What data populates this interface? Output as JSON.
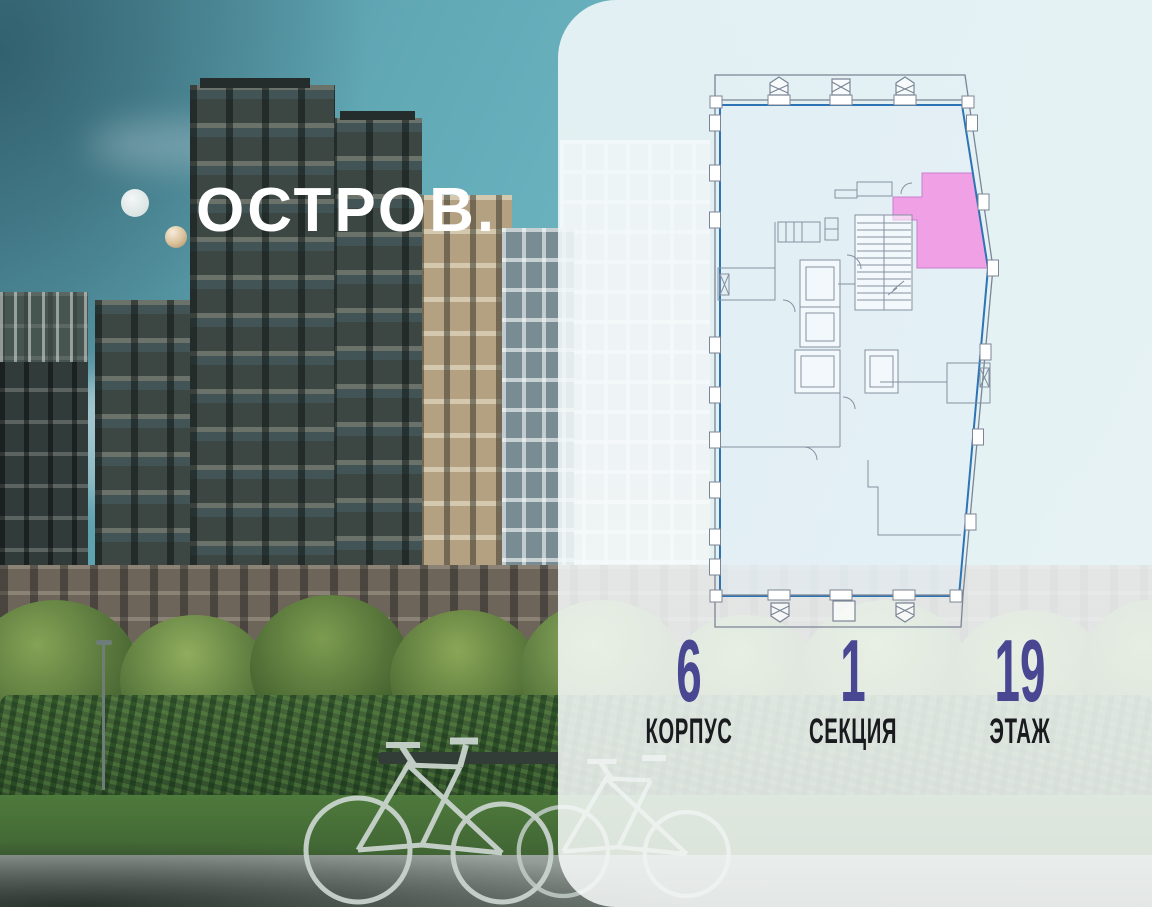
{
  "brand": {
    "name": "ОСТРОВ.",
    "mark": "gold-torus-ring-with-dot"
  },
  "floor_plan": {
    "description": "building floor plan, upper-right apartment highlighted",
    "selected_unit_highlighted": true,
    "colors": {
      "highlight": "#f19ae3",
      "walls": "#7b8595",
      "window_line": "#2e74b5"
    }
  },
  "stats": [
    {
      "value": "6",
      "label": "КОРПУС"
    },
    {
      "value": "1",
      "label": "СЕКЦИЯ"
    },
    {
      "value": "19",
      "label": "ЭТАЖ"
    }
  ],
  "colors": {
    "stat_number": "#4a4792",
    "stat_label": "#191b1e",
    "panel_background": "rgba(246,250,251,0.87)",
    "sky_teal": "#62a9b6",
    "logo_gold": "#d9c2a2",
    "logo_text": "#ffffff"
  }
}
